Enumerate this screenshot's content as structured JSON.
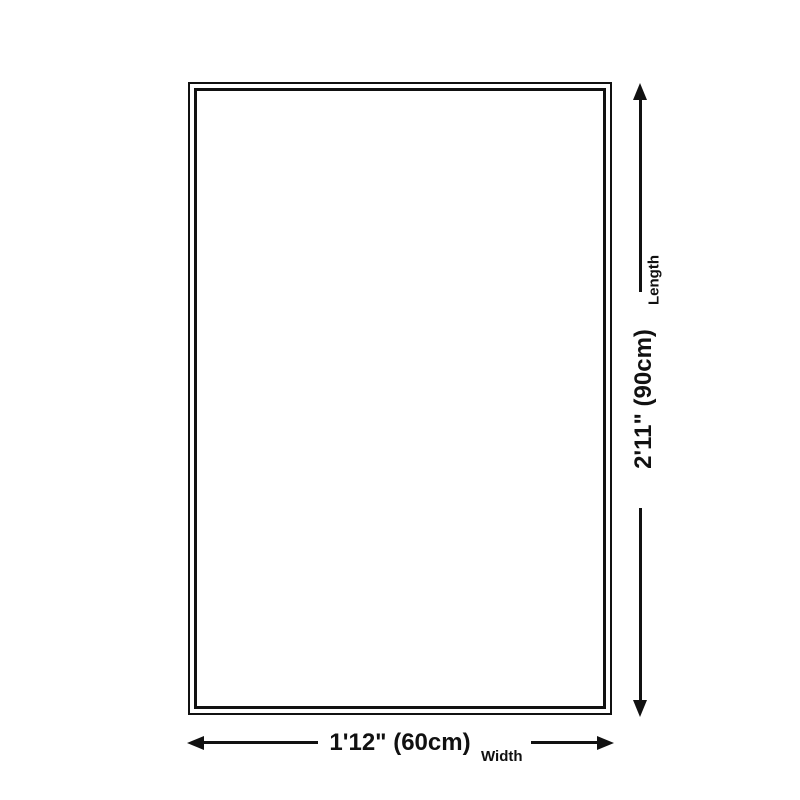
{
  "diagram": {
    "type": "product-dimension-diagram",
    "colors": {
      "line": "#111111",
      "background": "#ffffff"
    },
    "length_dimension": {
      "value": "2'11\" (90cm)",
      "label": "Length"
    },
    "width_dimension": {
      "value": "1'12\" (60cm)",
      "label": "Width"
    }
  }
}
